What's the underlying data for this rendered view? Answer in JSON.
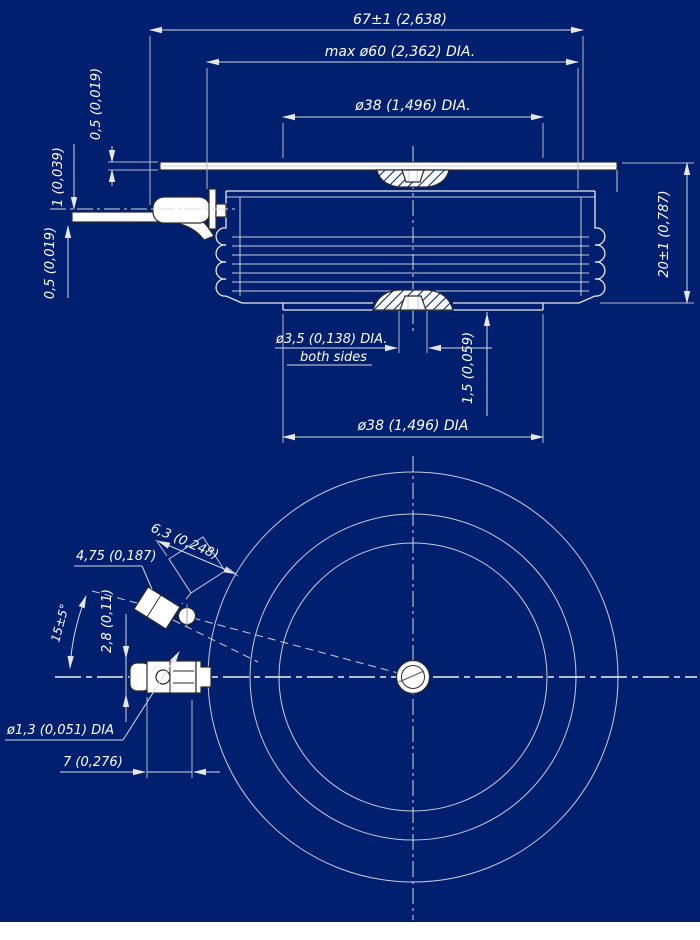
{
  "drawing": {
    "colors": {
      "background": "#001f6e",
      "line": "#e9e9e9",
      "dimension_text": "#ffffff",
      "part_fill": "#ffffff"
    },
    "section_view": {
      "dim_overall_width": "67±1 (2,638)",
      "dim_max_diameter": "max ø60 (2,362) DIA.",
      "dim_pole_diameter_top": "ø38 (1,496) DIA.",
      "dim_strip_thickness_top": "0,5 (0,019)",
      "dim_lead_thickness": "1 (0,039)",
      "dim_strip_thickness_bottom": "0,5 (0,019)",
      "dim_height": "20±1 (0,787)",
      "dim_center_hole_diameter": "ø3,5 (0,138) DIA.",
      "note_both_sides": "both sides",
      "dim_hole_depth": "1,5 (0,059)",
      "dim_pole_diameter_bottom": "ø38 (1,496) DIA"
    },
    "plan_view": {
      "dim_tab_width": "4,75 (0,187)",
      "dim_pad_size": "6,3 (0,248)",
      "dim_lead_angle": "15±5°",
      "dim_lug_height": "2,8 (0,11)",
      "dim_lug_hole_diameter": "ø1,3 (0,051) DIA",
      "dim_lug_length": "7 (0,276)"
    }
  }
}
